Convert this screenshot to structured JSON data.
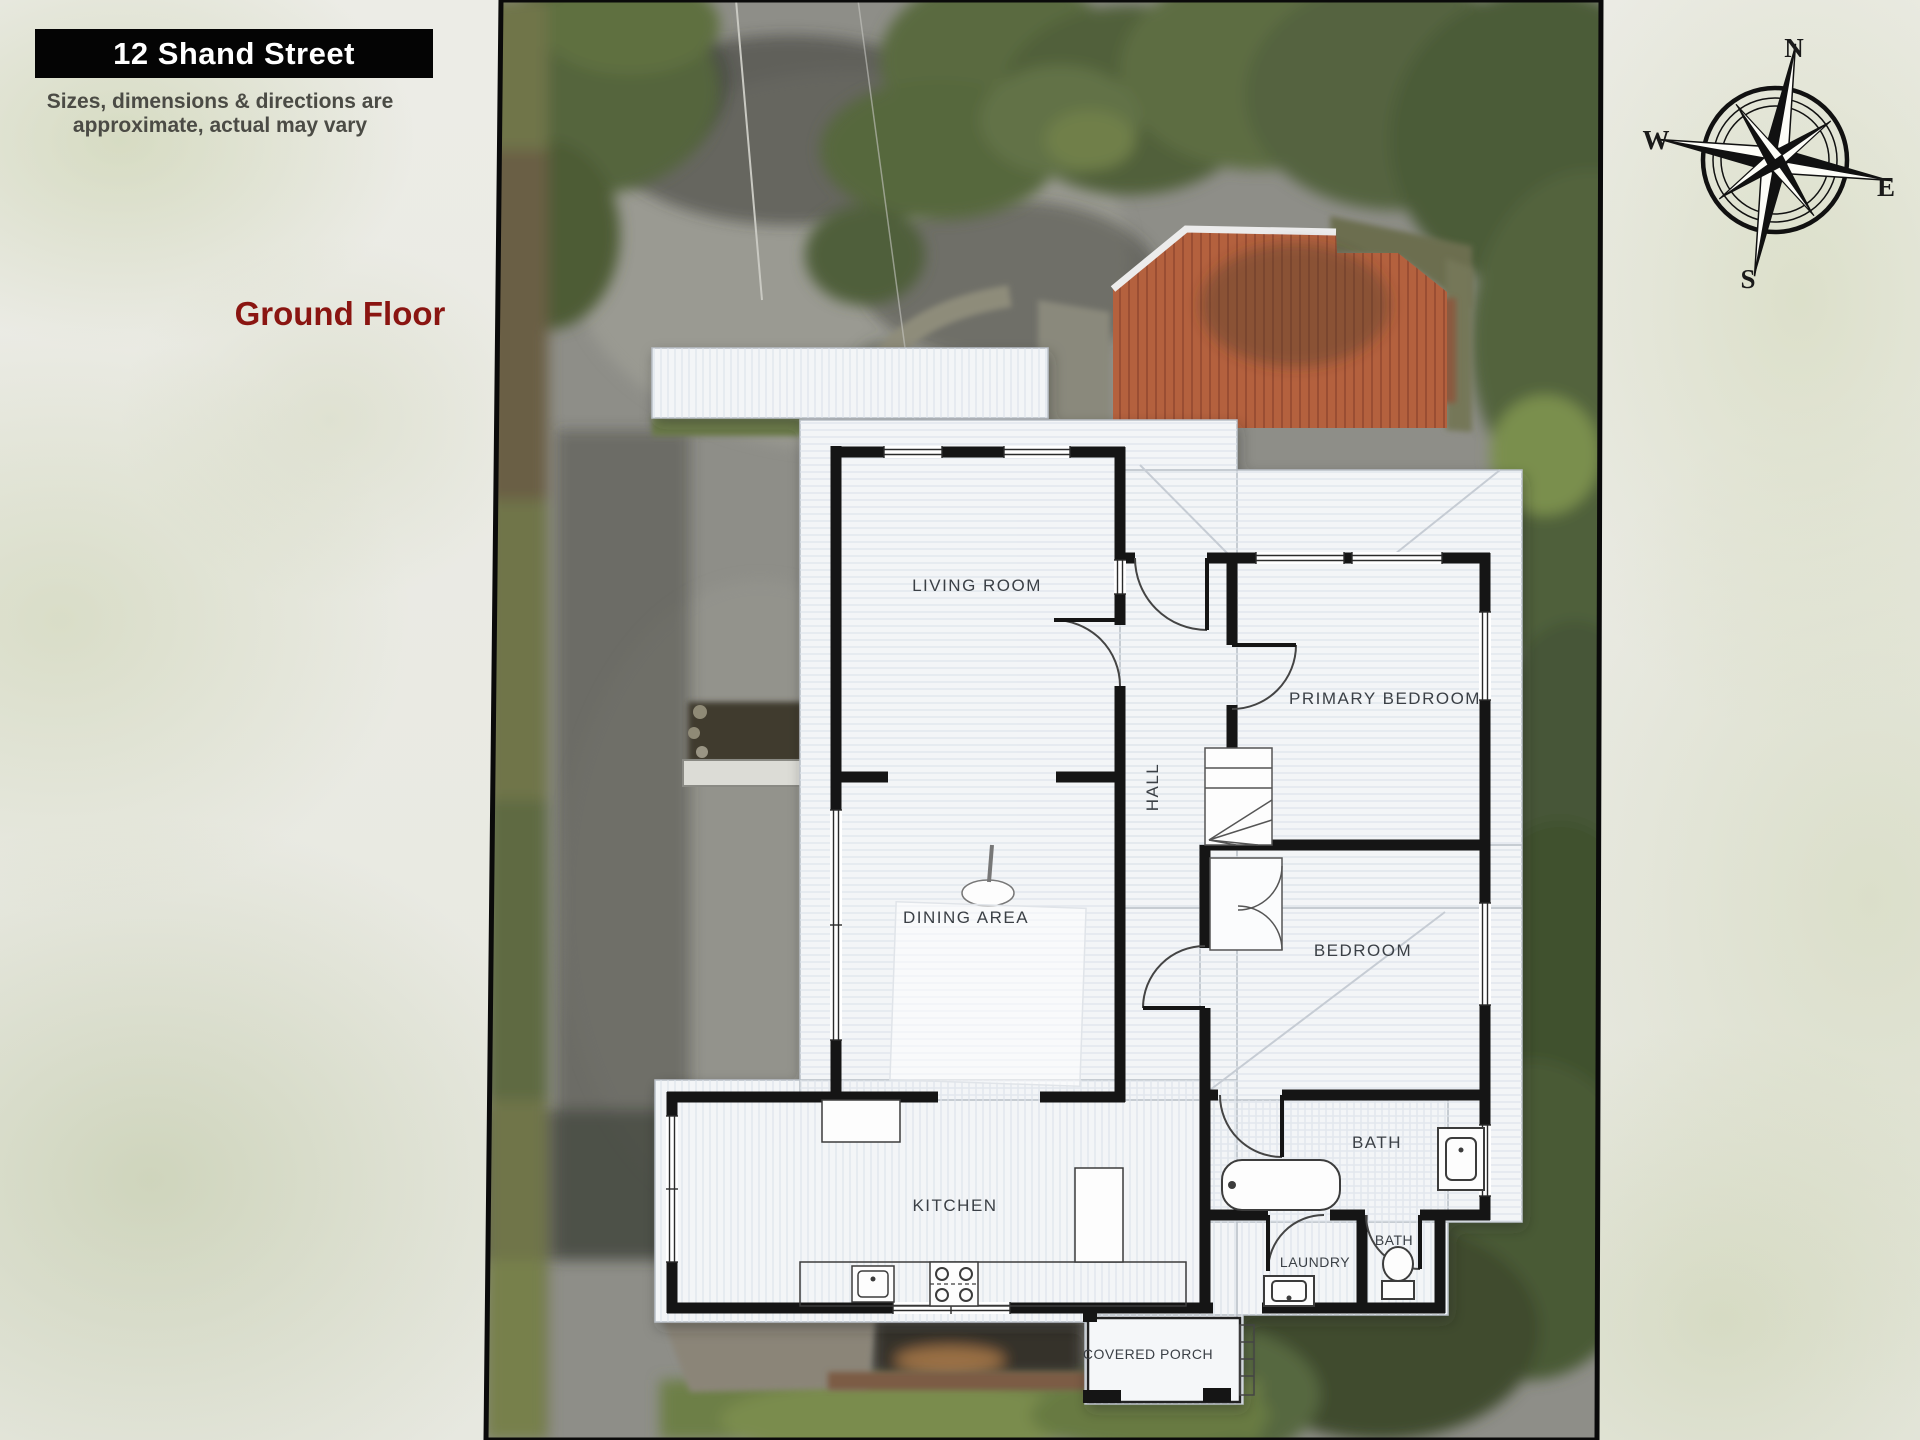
{
  "header": {
    "address": "12 Shand Street",
    "disclaimer": "Sizes, dimensions & directions are approximate, actual may vary",
    "floor": "Ground Floor"
  },
  "compass": {
    "n": "N",
    "e": "E",
    "s": "S",
    "w": "W"
  },
  "plan": {
    "rooms": {
      "living": {
        "label": "LIVING ROOM"
      },
      "primary": {
        "label": "PRIMARY BEDROOM"
      },
      "hall": {
        "label": "HALL"
      },
      "dining": {
        "label": "DINING AREA"
      },
      "bedroom": {
        "label": "BEDROOM"
      },
      "bath": {
        "label": "BATH"
      },
      "kitchen": {
        "label": "KITCHEN"
      },
      "bath2": {
        "label": "BATH"
      },
      "laundry": {
        "label": "LAUNDRY"
      },
      "porch": {
        "label": "COVERED PORCH"
      }
    }
  },
  "colors": {
    "banner_bg": "#040404",
    "banner_text": "#ffffff",
    "disclaimer_text": "#4b4b45",
    "floor_text": "#8a1511",
    "wall": "#151515",
    "roof_white": "#f3f5f7",
    "shed_roof": "#b4613e",
    "photo_border": "#0a0a0a"
  }
}
